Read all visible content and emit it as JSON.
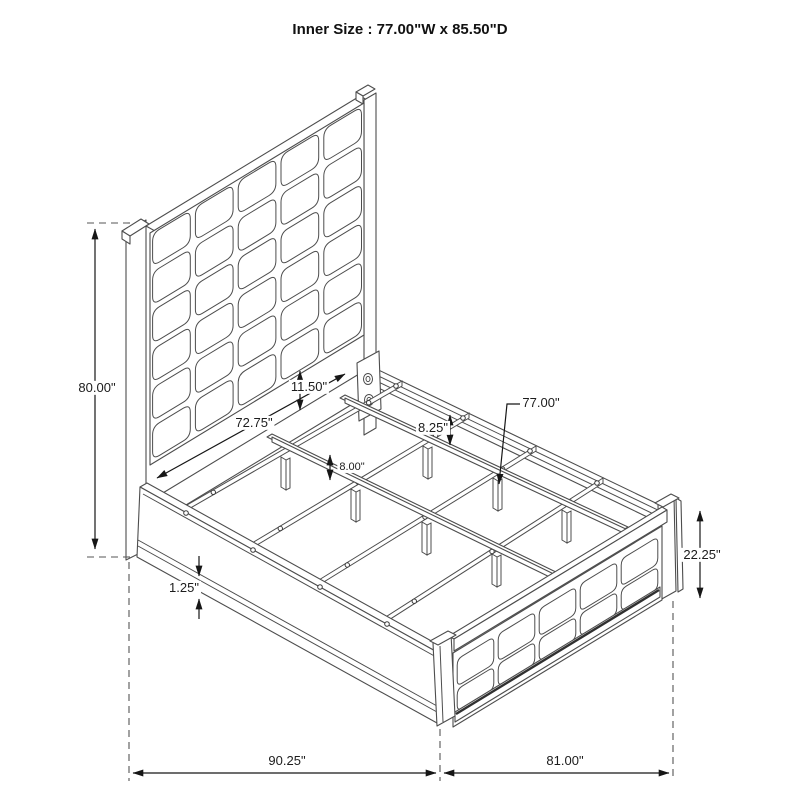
{
  "title": "Inner Size : 77.00\"W x 85.50\"D",
  "dimensions": {
    "headboard_height": "80.00\"",
    "headboard_rail_width": "72.75\"",
    "panel_to_rail_gap": "11.50\"",
    "side_rail_drop": "8.25\"",
    "slat_rail_width": "77.00\"",
    "support_leg_height": "8.00\"",
    "rail_lip_thickness": "1.25\"",
    "footboard_height": "22.25\"",
    "overall_depth": "90.25\"",
    "overall_width": "81.00\""
  }
}
